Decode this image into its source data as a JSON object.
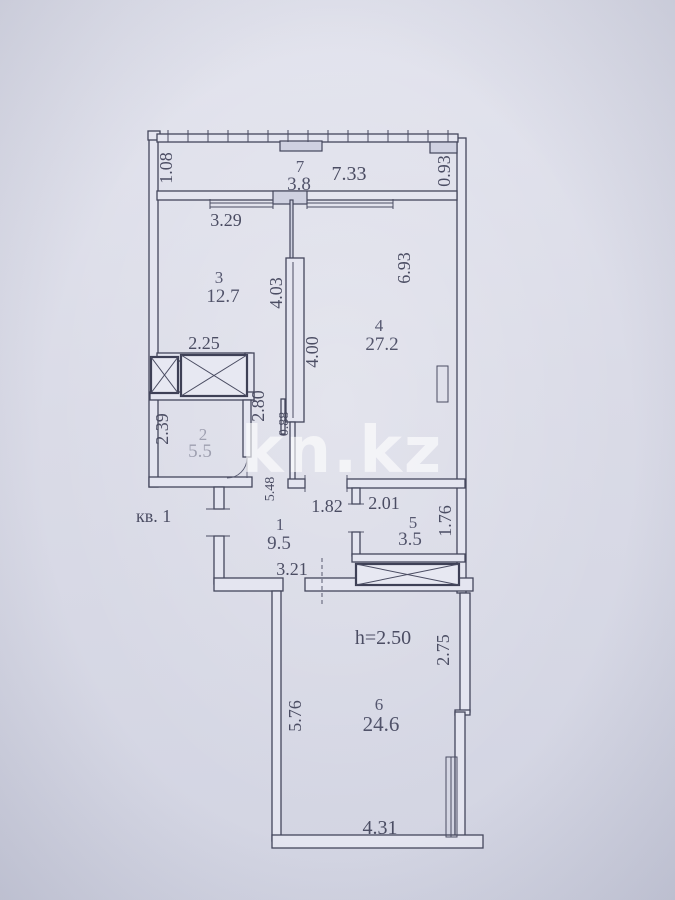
{
  "watermark": {
    "text": "kn.kz"
  },
  "apartment": {
    "label": "кв. 1",
    "ceiling_height": "h=2.50"
  },
  "rooms": {
    "r1": {
      "number": "1",
      "area": "9.5"
    },
    "r2": {
      "number": "2",
      "area": "5.5"
    },
    "r3": {
      "number": "3",
      "area": "12.7"
    },
    "r4": {
      "number": "4",
      "area": "27.2"
    },
    "r5": {
      "number": "5",
      "area": "3.5"
    },
    "r6": {
      "number": "6",
      "area": "24.6"
    },
    "r7": {
      "number": "7",
      "area": "3.8"
    }
  },
  "dims": {
    "balcony_left": "1.08",
    "balcony_width": "7.33",
    "balcony_right": "0.93",
    "room3_top": "3.29",
    "room3_bottom": "2.25",
    "room3_right": "4.03",
    "room4_left": "4.00",
    "room4_right": "6.93",
    "room2_left": "2.39",
    "room2_right": "2.80",
    "room2_niche": "0.88",
    "hall_left": "5.48",
    "hall_top": "1.82",
    "hall_bottom": "3.21",
    "room5_top": "2.01",
    "room5_right": "1.76",
    "room6_right": "2.75",
    "room6_left": "5.76",
    "room6_bottom": "4.31"
  },
  "colors": {
    "paper": "#dadbe7",
    "line": "#44465c",
    "text": "#4b4d63",
    "watermark": "#ffffff"
  }
}
